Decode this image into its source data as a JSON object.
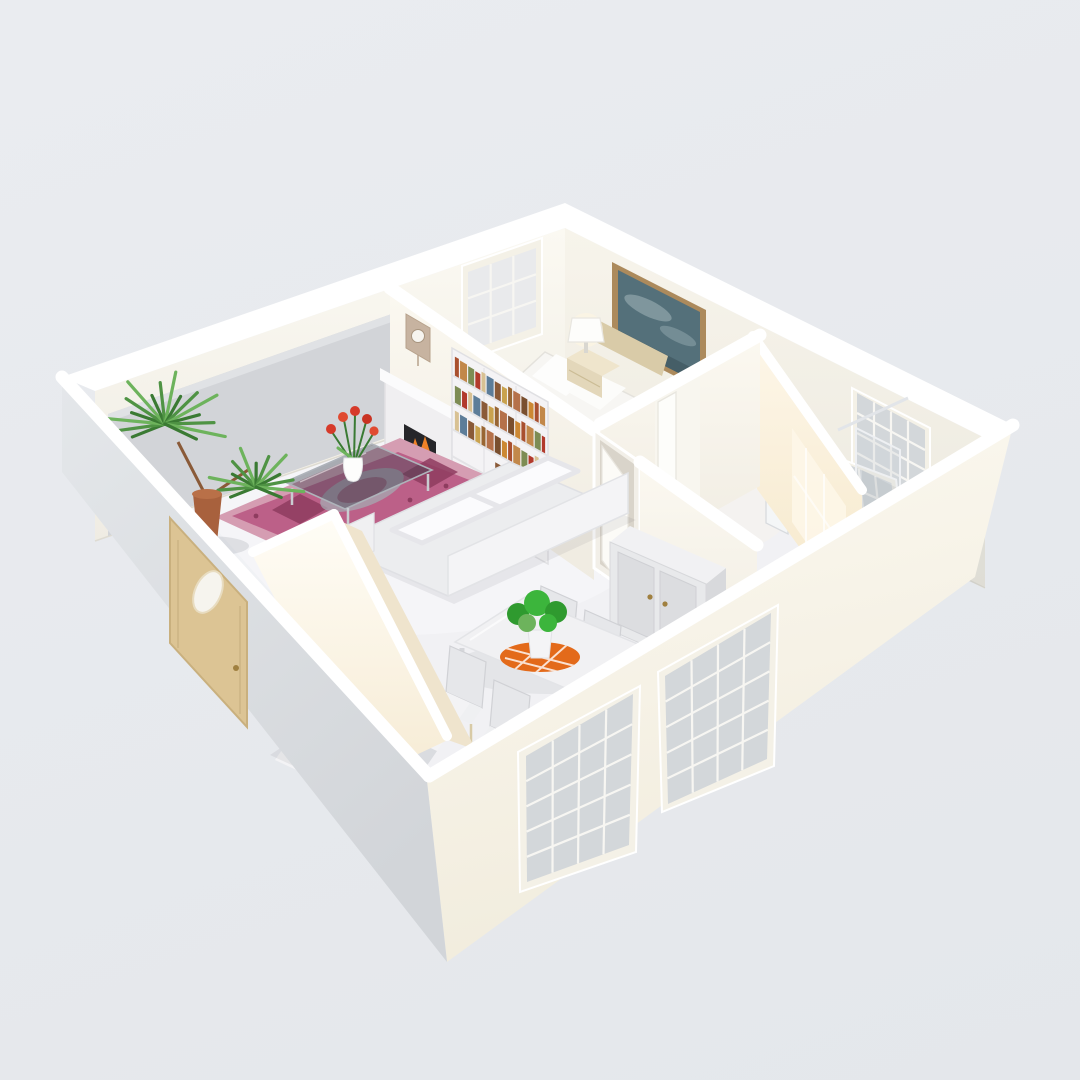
{
  "scene": {
    "type": "3d-floorplan-dollhouse-render",
    "view": "isometric-overhead",
    "rooms": [
      {
        "name": "living-room",
        "furniture": [
          "corner-palm-plant",
          "oriental-rug",
          "glass-coffee-table",
          "tulip-vase",
          "white-sofa",
          "fireplace",
          "wall-clock",
          "bookshelf",
          "back-wall-gray-panel",
          "small-back-window"
        ]
      },
      {
        "name": "bedroom",
        "furniture": [
          "bed",
          "headboard",
          "pillows",
          "foot-blanket",
          "nightstand",
          "table-lamp",
          "landscape-painting"
        ]
      },
      {
        "name": "hallway",
        "furniture": [
          "open-white-door",
          "wardrobe"
        ]
      },
      {
        "name": "bathroom",
        "furniture": [
          "toilet",
          "sink",
          "shower-screen",
          "sash-window-upper",
          "sash-window-tilted",
          "sunlight-patch"
        ]
      },
      {
        "name": "dining-area",
        "furniture": [
          "dining-table",
          "chair-1",
          "chair-2",
          "chair-3",
          "chair-4",
          "green-centerpiece",
          "orange-checkered-placemat",
          "pedestal-cylinder",
          "staircase",
          "stair-enclosure-wall"
        ]
      }
    ],
    "exterior": {
      "front_door": "wood-with-oval-glass",
      "front_windows": 2,
      "plant_behind_window": true
    }
  },
  "palette": {
    "bg_top": "#eaecf0",
    "bg_bottom": "#e4e7eb",
    "ext_left_a": "#e4e7ea",
    "ext_left_b": "#d2d5d9",
    "ext_right_a": "#fcf9f1",
    "ext_right_b": "#f1ecdd",
    "int_nw_a": "#fbf9f2",
    "int_nw_b": "#efece3",
    "int_ne_a": "#f7f4eb",
    "int_ne_b": "#ece9df",
    "int_div_a": "#fbf8f0",
    "int_div_b": "#efebe1",
    "warm_a": "#fdf6e8",
    "warm_b": "#f5e7c8",
    "warmwall_a": "#fffdf6",
    "warmwall_b": "#f6ebd4",
    "floor": "#f1f1f4",
    "floor_bright": "#fafafb",
    "gray_panel": "#d2d4d8",
    "glass": "#ccd1d7",
    "frame": "#f4f1e7",
    "door_tan": "#dcc494",
    "door_edge": "#c9b07e",
    "knob_brass": "#a08040",
    "rug_border": "#d59db2",
    "rug_field": "#bc6088",
    "rug_dark": "#8e3c5f",
    "rug_gray": "#a6a9b2",
    "sofa": "#ecedef",
    "sofa_back": "#f4f4f6",
    "cushion": "#fbfbfd",
    "table_glass": "#3f4650",
    "mantel": "#f0eff1",
    "firebox": "#26262a",
    "fire": "#f08228",
    "fire2": "#fcb944",
    "clock_tan": "#c7b3a0",
    "paint_frame": "#ac8a5c",
    "paint_canvas": "#54707a",
    "paint_cloud": "#8aa0a6",
    "paint_dark": "#3d555e",
    "wood": "#d9cba8",
    "nightstand": "#e3d7ba",
    "nightstand_top": "#efe5cc",
    "bed_blanket": "#e6dbc0",
    "wardrobe": "#e8e9eb",
    "wardrobe_panel": "#dcdde0",
    "wardrobe_side": "#d8d9dc",
    "plant_green": "#4f9344",
    "plant_dark": "#3a7a33",
    "plant_light": "#6db35c",
    "pot": "#a8613d",
    "mat_orange": "#e36a1a",
    "leaf_green": "#3cb53c",
    "leaf_dark": "#2f9a2f",
    "chair": "#e6e7ea",
    "chair_seat": "#eff0f2",
    "chair_leg": "#d8caa6",
    "stair_light": "#f3f3f5",
    "stair_dark": "#dadce0",
    "shelf_white": "#f4f3f5",
    "toilet": "#eef0f2"
  },
  "bookshelf": {
    "book_colors": [
      "#a9502f",
      "#c2884a",
      "#7d8c54",
      "#b23a2c",
      "#d8c193",
      "#5d7d99",
      "#8a5a38",
      "#c9a24e",
      "#996633",
      "#b5714a",
      "#7a4f2e",
      "#cc8833"
    ],
    "shelf_rows": 6,
    "rows_with_books": [
      {
        "row": 1,
        "t0": 0.03,
        "t1": 0.97
      },
      {
        "row": 2,
        "t0": 0.03,
        "t1": 0.97
      },
      {
        "row": 3,
        "t0": 0.03,
        "t1": 0.97
      },
      {
        "row": 4,
        "t0": 0.45,
        "t1": 0.97
      }
    ]
  },
  "stairs": {
    "steps": 7
  },
  "palm": {
    "clusters": [
      {
        "blades": 16
      },
      {
        "blades": 13
      }
    ]
  },
  "windows": {
    "front_left": {
      "cols": 4,
      "rows": 5
    },
    "front_right": {
      "cols": 4,
      "rows": 5
    },
    "bath_upper": {
      "cols": 4,
      "rows": 4
    },
    "bath_tilted": {
      "cols": 4,
      "rows": 3
    },
    "back_small": {
      "cols": 3,
      "rows": 3
    }
  }
}
